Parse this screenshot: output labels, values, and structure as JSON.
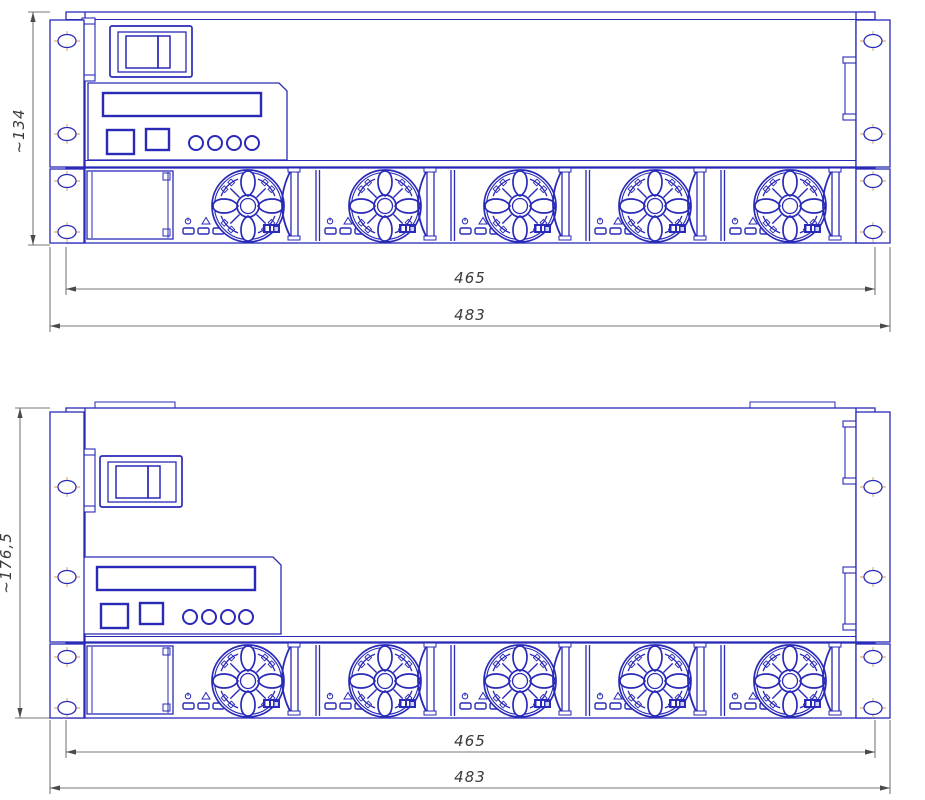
{
  "views": [
    {
      "name": "front-panel-2u",
      "height": "~134",
      "inner_width": "465",
      "outer_width": "483"
    },
    {
      "name": "front-panel-3u",
      "height": "~176,5",
      "inner_width": "465",
      "outer_width": "483"
    }
  ],
  "fan_module": {
    "fans_per_row": 5,
    "indicators": [
      {
        "icon": "power-icon"
      },
      {
        "icon": "alarm-icon"
      },
      {
        "icon": "fan-icon"
      }
    ]
  },
  "colors": {
    "line": "#2a2ab8",
    "dimension": "#4a4a4a",
    "centerline": "#d09a55",
    "background": "#ffffff"
  }
}
